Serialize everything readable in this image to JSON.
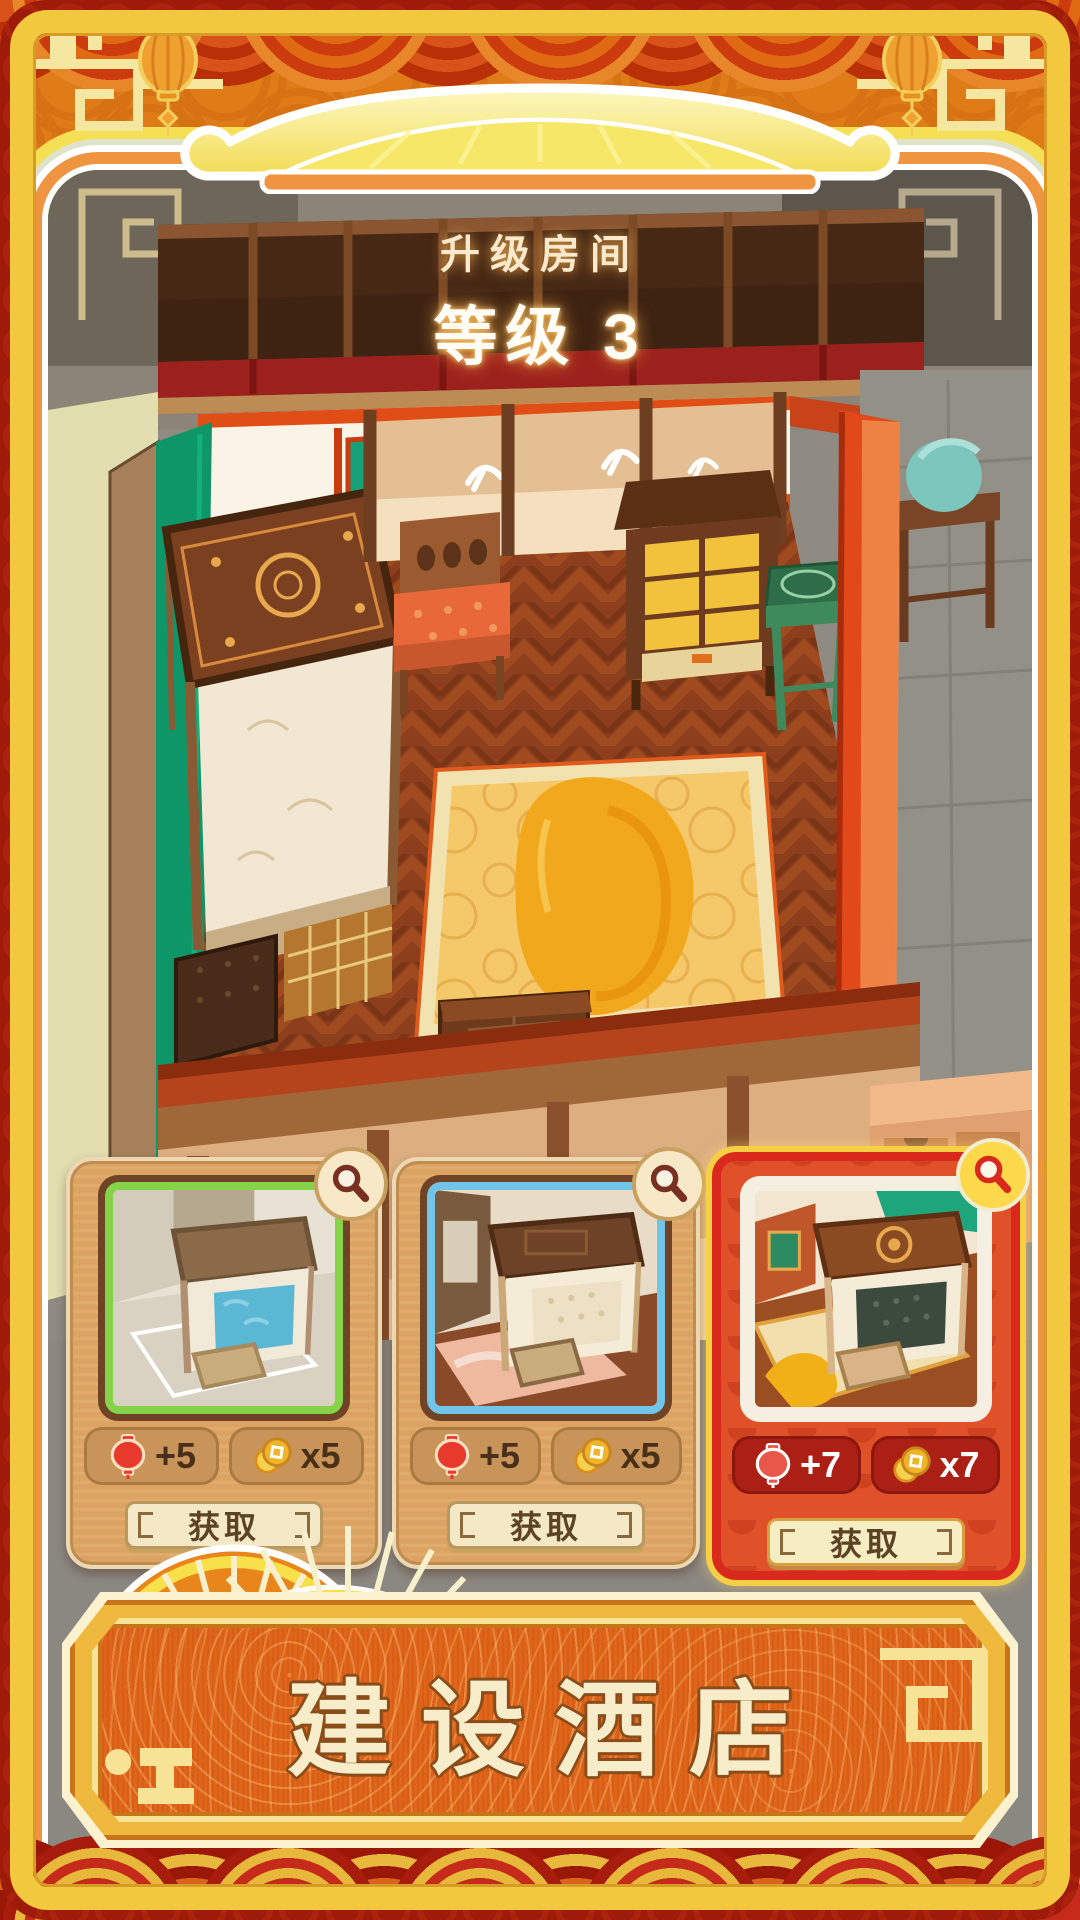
{
  "header": {
    "title": "升级房间",
    "level": "等级 3"
  },
  "cards": [
    {
      "name": "room-style-plain",
      "accent": "#84d348",
      "lantern": "+5",
      "coin": "x5",
      "button": "获取",
      "theme": "tan"
    },
    {
      "name": "room-style-warm",
      "accent": "#70c5e8",
      "lantern": "+5",
      "coin": "x5",
      "button": "获取",
      "theme": "tan"
    },
    {
      "name": "room-style-deluxe",
      "accent": "#f5efe2",
      "lantern": "+7",
      "coin": "x7",
      "button": "获取",
      "theme": "red"
    }
  ],
  "banner": {
    "label": "建设酒店"
  },
  "icons": {
    "card_badge": "magnifier-icon",
    "reward_a": "lantern-icon",
    "reward_b": "coin-icon"
  },
  "colors": {
    "frame_gold": "#f2c83e",
    "edge_red": "#9e1a09",
    "page_orange": "#e07c18",
    "card_tan": "#dca362",
    "card_red": "#e0512a",
    "pill_dark_red": "#ab1f14",
    "banner_orange": "#e0651a",
    "accent_green": "#84d348",
    "accent_blue": "#70c5e8"
  }
}
